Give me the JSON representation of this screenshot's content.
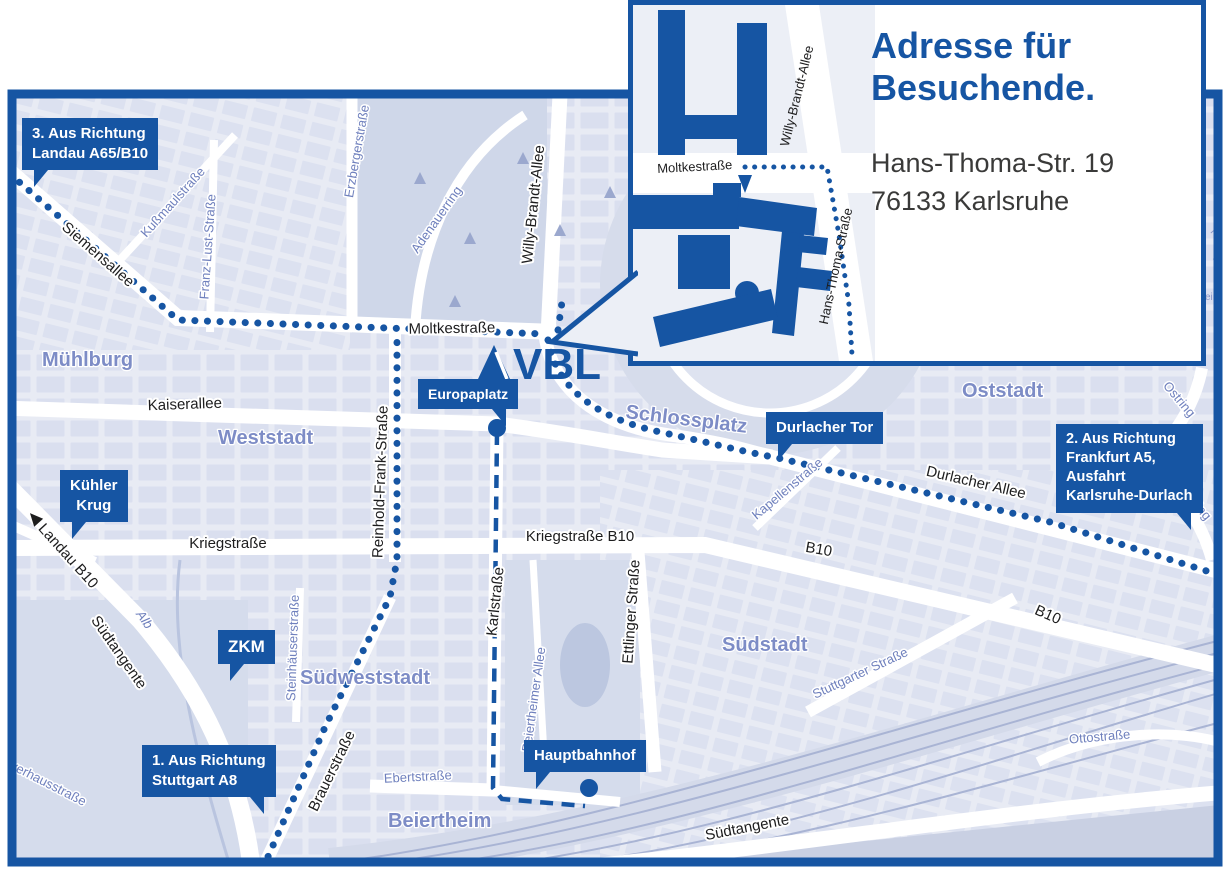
{
  "colors": {
    "brand_blue": "#1655A3",
    "map_background": "#E8EBF4",
    "city_block": "#DADFEF",
    "park": "#D6DCEB",
    "rail_line": "#A9B4D4",
    "district_text": "#7D8CC6",
    "street_blue_text": "#6F80BD",
    "street_black_text": "#1D1D1E",
    "marker_text": "#FFFFFF",
    "address_text": "#3A3A39"
  },
  "logo": {
    "text": "VBL"
  },
  "inset": {
    "title_line1": "Adresse für",
    "title_line2": "Besuchende.",
    "address_line1": "Hans-Thoma-Str. 19",
    "address_line2": "76133 Karlsruhe",
    "labels": {
      "moltkestrasse": "Moltkestraße",
      "willy_brandt_allee": "Willy-Brandt-Allee",
      "hans_thoma_strasse": "Hans-Thoma-Straße"
    }
  },
  "markers": {
    "m3": {
      "l1": "3. Aus Richtung",
      "l2": "Landau A65/B10"
    },
    "kuehler_krug": {
      "l1": "Kühler",
      "l2": "Krug"
    },
    "zkm": {
      "l1": "ZKM"
    },
    "m1": {
      "l1": "1. Aus Richtung",
      "l2": "Stuttgart A8"
    },
    "europaplatz": {
      "l1": "Europaplatz"
    },
    "durlacher_tor": {
      "l1": "Durlacher Tor"
    },
    "m2": {
      "l1": "2. Aus Richtung",
      "l2": "Frankfurt A5,",
      "l3": "Ausfahrt",
      "l4": "Karlsruhe-Durlach"
    },
    "hauptbahnhof": {
      "l1": "Hauptbahnhof"
    }
  },
  "streets_black": {
    "siemensallee": "Siemensallee",
    "moltkestrasse": "Moltkestraße",
    "kaiserallee": "Kaiserallee",
    "willy_brandt_allee": "Willy-Brandt-Allee",
    "kriegstrasse": "Kriegstraße",
    "kriegstrasse_b10": "Kriegstraße B10",
    "b10_mid": "B10",
    "b10_se": "B10",
    "durlacher_allee": "Durlacher Allee",
    "landau_b10": "Landau B10",
    "suedtangente_left": "Südtangente",
    "suedtangente_bottom": "Südtangente",
    "brauerstrasse": "Brauerstraße",
    "karlstrasse": "Karlstraße",
    "ettlinger_strasse": "Ettlinger Straße",
    "reinhold_frank_strasse": "Reinhold-Frank-Straße"
  },
  "streets_blue": {
    "kussmaulstrasse": "Kußmaulstraße",
    "franz_lust_strasse": "Franz-Lust-Straße",
    "erzbergerstrasse": "Erzbergerstraße",
    "adenauerring": "Adenauerring",
    "kapellenstrasse": "Kapellenstraße",
    "ostring_1": "Ostring",
    "ostring_2": "Ostring",
    "steinhaeuserstrasse": "Steinhäuserstraße",
    "alb": "Alb",
    "pulverhausstrasse": "Pulverhausstraße",
    "ebertstrasse": "Ebertstraße",
    "beiertheimer_allee": "Beiertheimer Allee",
    "stuttgarter_strasse": "Stuttgarter Straße",
    "ottostrasse": "Ottostraße"
  },
  "districts": {
    "muehlburg": "Mühlburg",
    "weststadt": "Weststadt",
    "oststadt": "Oststadt",
    "suedstadt": "Südstadt",
    "suedweststadt": "Südweststadt",
    "beiertheim": "Beiertheim",
    "schlossplatz": "Schlossplatz"
  },
  "fragments": {
    "f1": "Ha",
    "f2": "we",
    "f3": "ein"
  }
}
